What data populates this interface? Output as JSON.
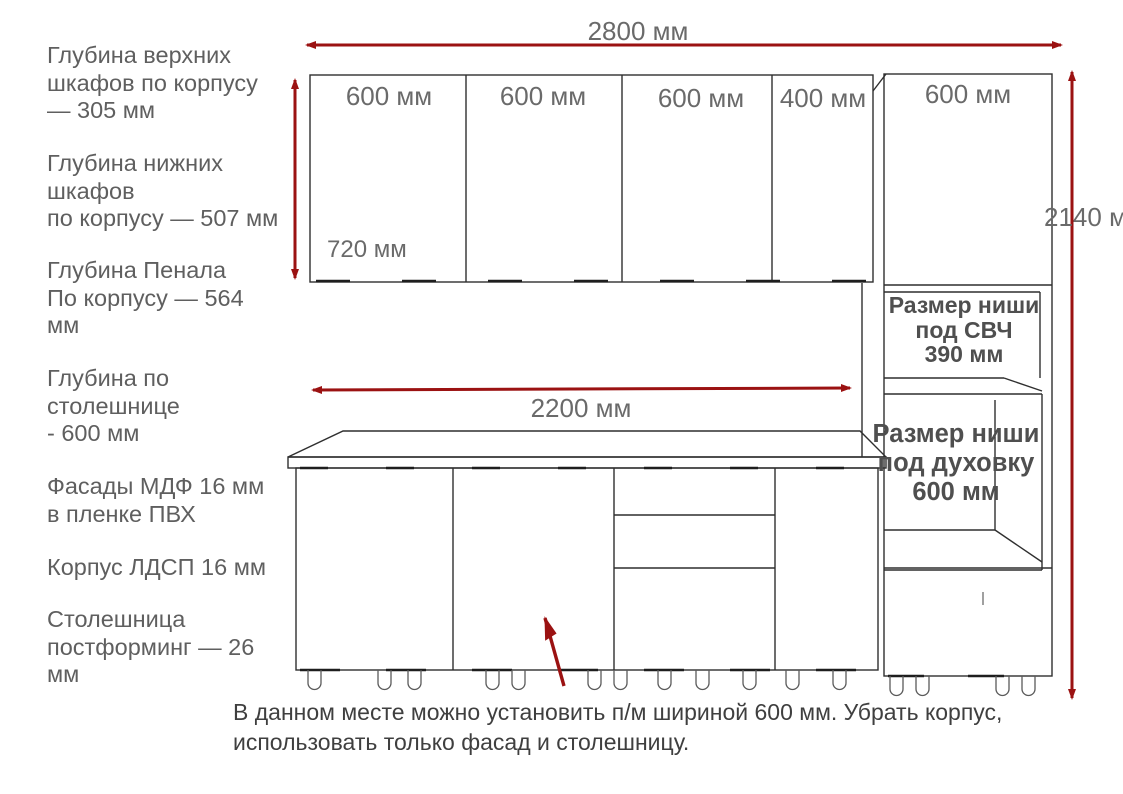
{
  "title": "Kitchen cabinet dimension drawing",
  "colors": {
    "arrow_red": "#9b1212",
    "drawing_line": "#2f2f2f",
    "label_gray": "#5f5f5f",
    "note_dark": "#3f3f3f"
  },
  "left_notes": [
    "Глубина верхних\nшкафов по корпусу\n— 305 мм",
    "Глубина нижних\nшкафов\nпо корпусу — 507 мм",
    "Глубина Пенала\nПо корпусу — 564\nмм",
    "Глубина по\nстолешнице\n- 600 мм",
    "Фасады МДФ 16 мм\nв пленке ПВХ",
    "Корпус ЛДСП 16 мм",
    "Столешница\nпостформинг — 26\nмм"
  ],
  "dimension_labels": {
    "total_width": "2800 мм",
    "countertop_width": "2200 мм",
    "total_height": "2140 мм",
    "upper_cabinet_height": "720 мм"
  },
  "upper_cabinet_labels": [
    "600 мм",
    "600 мм",
    "600 мм",
    "400 мм"
  ],
  "tall_cabinet_label": "600 мм",
  "niche_labels": {
    "microwave": "Размер ниши\nпод СВЧ\n390 мм",
    "oven": "Размер ниши\nпод духовку\n600 мм"
  },
  "bottom_note": "В данном месте можно установить п/м шириной 600 мм. Убрать корпус,\nиспользовать только фасад и столешницу."
}
